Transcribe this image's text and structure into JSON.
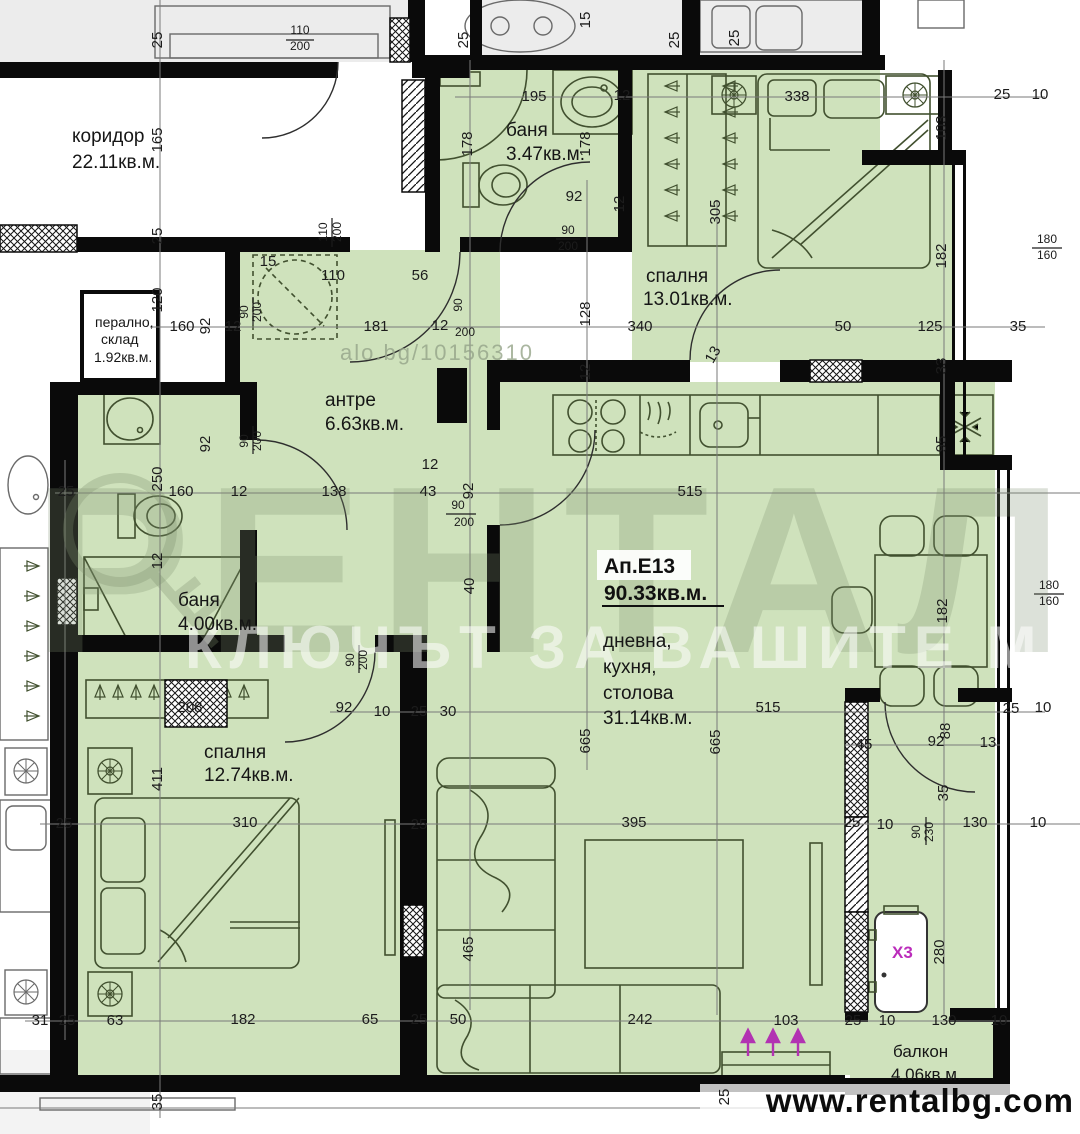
{
  "apartment": {
    "label": "Ап.Е13",
    "area": "90.33кв.м."
  },
  "rooms": [
    {
      "name": "коридор",
      "area": "22.11кв.м."
    },
    {
      "name": "баня",
      "area": "3.47кв.м."
    },
    {
      "name": "спалня",
      "area": "13.01кв.м."
    },
    {
      "name": "перално,",
      "name2": "склад",
      "area": "1.92кв.м."
    },
    {
      "name": "антре",
      "area": "6.63кв.м."
    },
    {
      "name": "баня",
      "area": "4.00кв.м."
    },
    {
      "name": "спалня",
      "area": "12.74кв.м."
    },
    {
      "name": "дневна,",
      "name2": "кухня,",
      "name3": "столова",
      "area": "31.14кв.м."
    },
    {
      "name": "балкон",
      "area": "4.06кв.м."
    }
  ],
  "unit": {
    "x3": "X3"
  },
  "watermark": {
    "brand": "РЕНТАЛ",
    "slogan": "КЛЮЧЪТ ЗА ВАШИТЕ МЕЧТИ",
    "listing": "alo.bg/10156310"
  },
  "website": "www.rentalbg.com",
  "colors": {
    "room_fill": "#cfe2bc",
    "wall": "#0a0a0a",
    "accent_magenta": "#bb2cbb"
  },
  "icons": [
    "washing-machine-icon",
    "snowflake-fridge-icon",
    "cooktop-icon",
    "hanger-icon",
    "lamp-icon"
  ],
  "dims": [
    {
      "t": "25",
      "x": 162,
      "y": 40,
      "r": -90
    },
    {
      "t": "110",
      "x": 300,
      "y": 34,
      "s": 1
    },
    {
      "t": "200",
      "x": 300,
      "y": 50,
      "s": 1
    },
    {
      "t": "165",
      "x": 162,
      "y": 140,
      "r": -90
    },
    {
      "t": "25",
      "x": 162,
      "y": 236,
      "r": -90
    },
    {
      "t": "110",
      "x": 327,
      "y": 232,
      "r": -90,
      "s": 1
    },
    {
      "t": "200",
      "x": 341,
      "y": 232,
      "r": -90,
      "s": 1
    },
    {
      "t": "15",
      "x": 268,
      "y": 266
    },
    {
      "t": "110",
      "x": 333,
      "y": 280
    },
    {
      "t": "120",
      "x": 162,
      "y": 300,
      "r": -90
    },
    {
      "t": "160",
      "x": 182,
      "y": 331
    },
    {
      "t": "92",
      "x": 210,
      "y": 326,
      "r": -90
    },
    {
      "t": "12",
      "x": 233,
      "y": 331
    },
    {
      "t": "90",
      "x": 248,
      "y": 312,
      "r": -90,
      "s": 1
    },
    {
      "t": "200",
      "x": 261,
      "y": 312,
      "r": -90,
      "s": 1
    },
    {
      "t": "181",
      "x": 376,
      "y": 331
    },
    {
      "t": "56",
      "x": 420,
      "y": 280
    },
    {
      "t": "15",
      "x": 590,
      "y": 20,
      "r": -90
    },
    {
      "t": "25",
      "x": 468,
      "y": 40,
      "r": -90
    },
    {
      "t": "25",
      "x": 679,
      "y": 40,
      "r": -90
    },
    {
      "t": "25",
      "x": 739,
      "y": 38,
      "r": -90
    },
    {
      "t": "195",
      "x": 534,
      "y": 101
    },
    {
      "t": "12",
      "x": 622,
      "y": 100
    },
    {
      "t": "338",
      "x": 797,
      "y": 101
    },
    {
      "t": "25",
      "x": 1002,
      "y": 99
    },
    {
      "t": "10",
      "x": 1040,
      "y": 99
    },
    {
      "t": "103",
      "x": 946,
      "y": 128,
      "r": -90
    },
    {
      "t": "178",
      "x": 472,
      "y": 144,
      "r": -90
    },
    {
      "t": "178",
      "x": 590,
      "y": 144,
      "r": -90
    },
    {
      "t": "92",
      "x": 574,
      "y": 201
    },
    {
      "t": "12",
      "x": 624,
      "y": 204,
      "r": -90
    },
    {
      "t": "90",
      "x": 568,
      "y": 234,
      "s": 1
    },
    {
      "t": "200",
      "x": 568,
      "y": 250,
      "s": 1
    },
    {
      "t": "305",
      "x": 720,
      "y": 212,
      "r": -90
    },
    {
      "t": "182",
      "x": 946,
      "y": 256,
      "r": -90
    },
    {
      "t": "180",
      "x": 1047,
      "y": 243,
      "s": 1
    },
    {
      "t": "160",
      "x": 1047,
      "y": 259,
      "s": 1
    },
    {
      "t": "90",
      "x": 462,
      "y": 305,
      "r": -90,
      "s": 1
    },
    {
      "t": "12",
      "x": 440,
      "y": 330
    },
    {
      "t": "200",
      "x": 465,
      "y": 336,
      "s": 1
    },
    {
      "t": "128",
      "x": 590,
      "y": 314,
      "r": -90
    },
    {
      "t": "340",
      "x": 640,
      "y": 331
    },
    {
      "t": "50",
      "x": 843,
      "y": 331
    },
    {
      "t": "125",
      "x": 930,
      "y": 331
    },
    {
      "t": "35",
      "x": 1018,
      "y": 331
    },
    {
      "t": "13",
      "x": 717,
      "y": 357,
      "r": -60
    },
    {
      "t": "12",
      "x": 590,
      "y": 372,
      "r": -90
    },
    {
      "t": "33",
      "x": 946,
      "y": 366,
      "r": -90
    },
    {
      "t": "95",
      "x": 946,
      "y": 444,
      "r": -90
    },
    {
      "t": "12",
      "x": 430,
      "y": 469
    },
    {
      "t": "43",
      "x": 428,
      "y": 496
    },
    {
      "t": "92",
      "x": 473,
      "y": 491,
      "r": -90
    },
    {
      "t": "90",
      "x": 458,
      "y": 509,
      "s": 1
    },
    {
      "t": "200",
      "x": 464,
      "y": 526,
      "s": 1
    },
    {
      "t": "515",
      "x": 690,
      "y": 496
    },
    {
      "t": "25",
      "x": 66,
      "y": 496
    },
    {
      "t": "250",
      "x": 162,
      "y": 479,
      "r": -90
    },
    {
      "t": "160",
      "x": 181,
      "y": 496
    },
    {
      "t": "12",
      "x": 239,
      "y": 496
    },
    {
      "t": "138",
      "x": 334,
      "y": 496
    },
    {
      "t": "92",
      "x": 210,
      "y": 444,
      "r": -90
    },
    {
      "t": "90",
      "x": 248,
      "y": 441,
      "r": -90,
      "s": 1
    },
    {
      "t": "200",
      "x": 261,
      "y": 441,
      "r": -90,
      "s": 1
    },
    {
      "t": "12",
      "x": 162,
      "y": 561,
      "r": -90
    },
    {
      "t": "40",
      "x": 474,
      "y": 586,
      "r": -90
    },
    {
      "t": "90",
      "x": 354,
      "y": 660,
      "r": -90,
      "s": 1
    },
    {
      "t": "200",
      "x": 367,
      "y": 660,
      "r": -90,
      "s": 1
    },
    {
      "t": "208",
      "x": 190,
      "y": 712
    },
    {
      "t": "92",
      "x": 344,
      "y": 712
    },
    {
      "t": "10",
      "x": 382,
      "y": 716
    },
    {
      "t": "25",
      "x": 419,
      "y": 716
    },
    {
      "t": "30",
      "x": 448,
      "y": 716
    },
    {
      "t": "665",
      "x": 590,
      "y": 741,
      "r": -90
    },
    {
      "t": "665",
      "x": 720,
      "y": 742,
      "r": -90
    },
    {
      "t": "515",
      "x": 768,
      "y": 712
    },
    {
      "t": "45",
      "x": 864,
      "y": 749
    },
    {
      "t": "92",
      "x": 936,
      "y": 746
    },
    {
      "t": "88",
      "x": 950,
      "y": 731,
      "r": -90
    },
    {
      "t": "13",
      "x": 988,
      "y": 747
    },
    {
      "t": "25",
      "x": 1011,
      "y": 713
    },
    {
      "t": "10",
      "x": 1043,
      "y": 712
    },
    {
      "t": "35",
      "x": 948,
      "y": 793,
      "r": -90
    },
    {
      "t": "411",
      "x": 162,
      "y": 779,
      "r": -90
    },
    {
      "t": "25",
      "x": 64,
      "y": 828
    },
    {
      "t": "310",
      "x": 245,
      "y": 827
    },
    {
      "t": "25",
      "x": 419,
      "y": 829
    },
    {
      "t": "395",
      "x": 634,
      "y": 827
    },
    {
      "t": "25",
      "x": 852,
      "y": 827
    },
    {
      "t": "10",
      "x": 885,
      "y": 829
    },
    {
      "t": "90",
      "x": 920,
      "y": 832,
      "r": -90,
      "s": 1
    },
    {
      "t": "230",
      "x": 933,
      "y": 832,
      "r": -90,
      "s": 1
    },
    {
      "t": "130",
      "x": 975,
      "y": 827
    },
    {
      "t": "10",
      "x": 1038,
      "y": 827
    },
    {
      "t": "182",
      "x": 947,
      "y": 611,
      "r": -90
    },
    {
      "t": "180",
      "x": 1049,
      "y": 589,
      "s": 1
    },
    {
      "t": "160",
      "x": 1049,
      "y": 605,
      "s": 1
    },
    {
      "t": "465",
      "x": 473,
      "y": 949,
      "r": -90
    },
    {
      "t": "280",
      "x": 944,
      "y": 952,
      "r": -90
    },
    {
      "t": "31",
      "x": 40,
      "y": 1025
    },
    {
      "t": "25",
      "x": 67,
      "y": 1025
    },
    {
      "t": "63",
      "x": 115,
      "y": 1025
    },
    {
      "t": "182",
      "x": 243,
      "y": 1024
    },
    {
      "t": "65",
      "x": 370,
      "y": 1024
    },
    {
      "t": "25",
      "x": 419,
      "y": 1024
    },
    {
      "t": "50",
      "x": 458,
      "y": 1024
    },
    {
      "t": "242",
      "x": 640,
      "y": 1024
    },
    {
      "t": "103",
      "x": 786,
      "y": 1025
    },
    {
      "t": "25",
      "x": 853,
      "y": 1025
    },
    {
      "t": "10",
      "x": 887,
      "y": 1025
    },
    {
      "t": "130",
      "x": 944,
      "y": 1025
    },
    {
      "t": "10",
      "x": 999,
      "y": 1025
    },
    {
      "t": "25",
      "x": 729,
      "y": 1097,
      "r": -90
    },
    {
      "t": "35",
      "x": 162,
      "y": 1102,
      "r": -90
    }
  ]
}
